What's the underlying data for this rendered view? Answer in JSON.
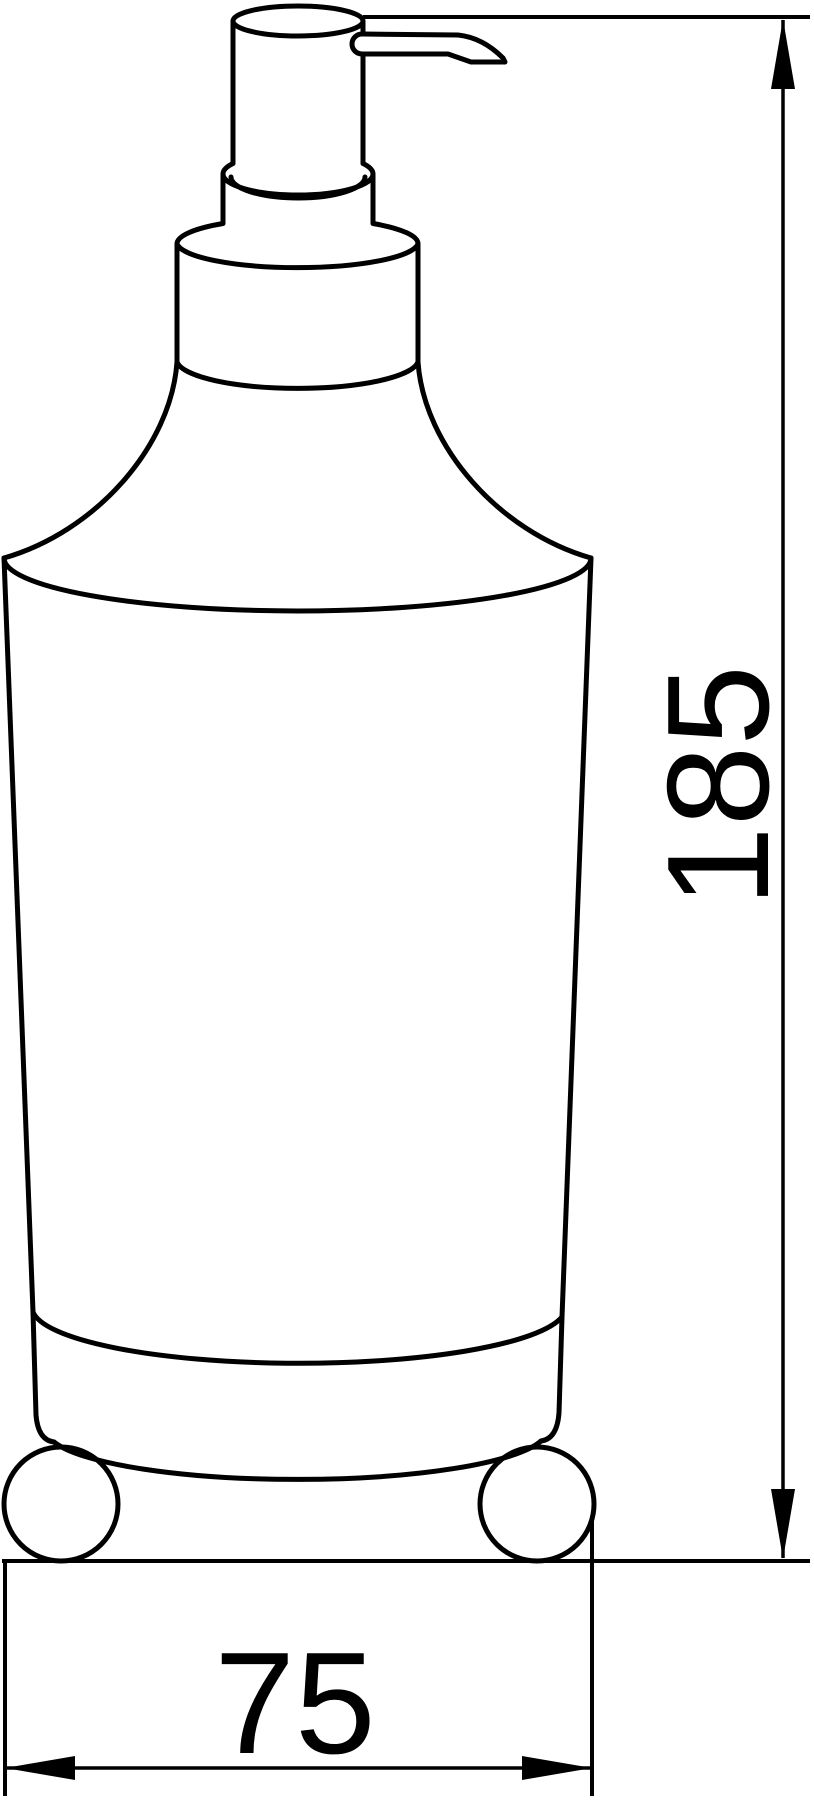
{
  "page": {
    "background_color": "#ffffff"
  },
  "drawing": {
    "description": "Technical dimension line drawing of a freestanding soap dispenser with pump top, holder ring and two ball feet",
    "line_color": "#000000",
    "dimensions": {
      "height": {
        "value": "185",
        "orientation": "vertical"
      },
      "width": {
        "value": "75",
        "orientation": "horizontal"
      }
    }
  }
}
